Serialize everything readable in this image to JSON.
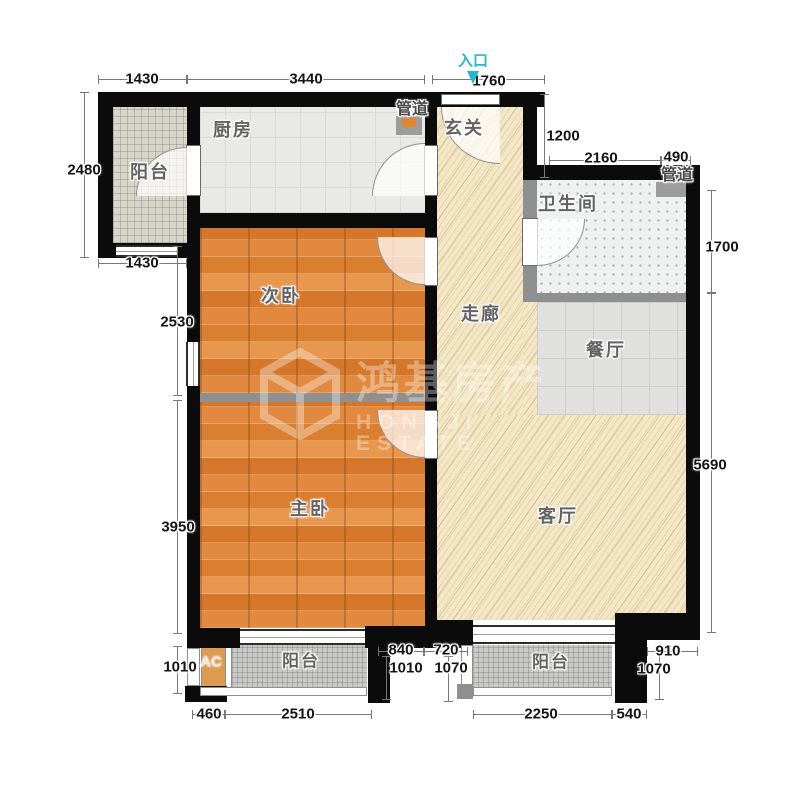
{
  "entrance": {
    "label": "入口"
  },
  "rooms": {
    "balcony_tl": "阳台",
    "kitchen": "厨房",
    "foyer": "玄关",
    "corridor": "走廊",
    "bathroom": "卫生间",
    "dining": "餐厅",
    "bedroom2": "次卧",
    "bedroom1": "主卧",
    "living": "客厅",
    "balcony_bl": "阳台",
    "balcony_br": "阳台",
    "ac": "AC"
  },
  "pipes": {
    "kitchen": "管道",
    "bathroom": "管道"
  },
  "dims": {
    "balcony_tl_width": "1430",
    "kitchen_width": "3440",
    "entry_width": "1760",
    "balcony_tl_height": "2480",
    "balcony_tl_bottom": "1430",
    "bedroom2_height": "2530",
    "bedroom1_height": "3950",
    "balcony_bl_height": "1010",
    "ac_width": "460",
    "balcony_bl_width": "2510",
    "mid_left_width": "840",
    "mid_left_height": "1010",
    "mid_right_width": "720",
    "mid_right_height": "1070",
    "balcony_br_width": "2250",
    "balcony_br_side": "540",
    "corner_right_width": "910",
    "corner_right_height": "1070",
    "foyer_height": "1200",
    "bathroom_width": "2160",
    "pipe_shaft_width": "490",
    "bathroom_height": "1700",
    "living_height": "5690"
  },
  "watermark": {
    "cn": "鸿基房产",
    "en": "HONGJI ESTATE"
  },
  "colors": {
    "wall": "#0b0b0b",
    "wood": "#dc8133",
    "cream": "#f4e7c6",
    "entrance_accent": "#25b7cf"
  }
}
